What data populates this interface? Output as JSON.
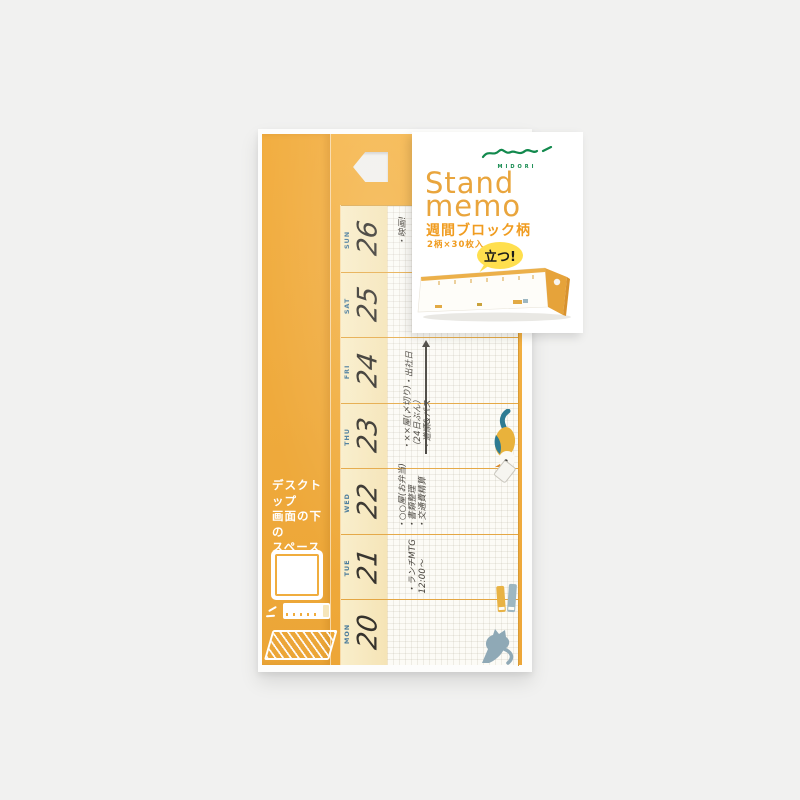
{
  "label": {
    "brand": "MIDORI",
    "title_line1": "Stand",
    "title_line2": "memo",
    "subtitle": "週間ブロック柄",
    "spec": "2柄×30枚入",
    "badge": "立つ!"
  },
  "side_panel": {
    "line1": "デスクトップ",
    "line2": "画面の下の",
    "line3": "スペースを",
    "line4": "活用!"
  },
  "calendar": {
    "rows": [
      {
        "day": "SUN",
        "date": "26",
        "note1": "・映画!"
      },
      {
        "day": "SAT",
        "date": "25"
      },
      {
        "day": "FRI",
        "date": "24",
        "note1": "・出社日"
      },
      {
        "day": "THU",
        "date": "23",
        "note1": "・××屋(〆切り)",
        "note2": "（24日ぶん）",
        "note3": "・道順&バス"
      },
      {
        "day": "WED",
        "date": "22",
        "note1": "・○○屋(お弁当)",
        "note2": "・書類整理",
        "note3": "・交通費精算"
      },
      {
        "day": "TUE",
        "date": "21",
        "note1": "・ランチMTG",
        "note2": "12:00〜"
      },
      {
        "day": "MON",
        "date": "20"
      }
    ]
  },
  "colors": {
    "background": "#f1f1f0",
    "package_orange": "#f0ac3e",
    "cream": "#f7e9c2",
    "day_label_blue": "#4a7b9b",
    "title_orange": "#e9a53d",
    "accent_orange": "#f09c20",
    "badge_yellow": "#ffdf4e",
    "logo_green": "#12894d",
    "handwriting_ink": "#45413a"
  }
}
